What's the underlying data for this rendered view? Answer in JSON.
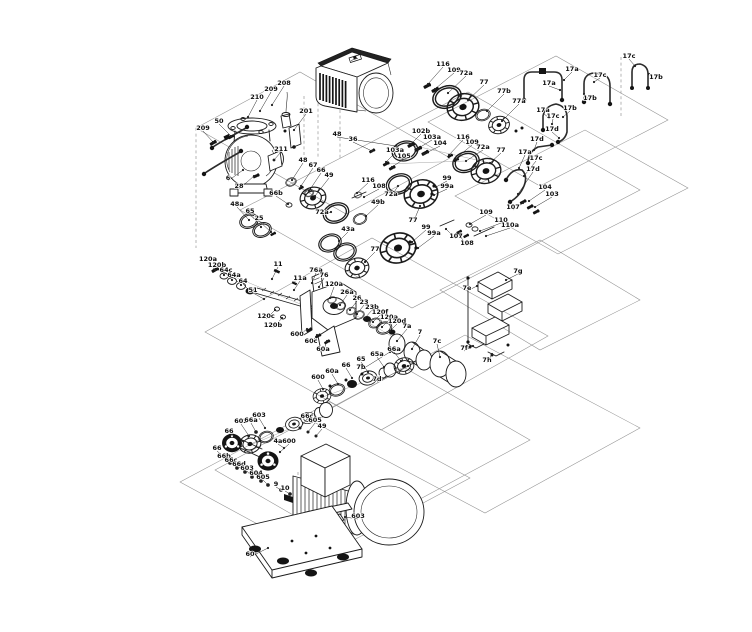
{
  "diagram": {
    "description": "Exploded parts diagram of a centrifugal pump unit with drive head, shaft seal kits, vent pipe kits, bearing assembly, impeller stack, coupling, motor and base plate",
    "colors": {
      "background": "#ffffff",
      "line": "#1c1c1c",
      "label": "#0e0e0e"
    },
    "callouts": [
      {
        "t": "209",
        "x": 203,
        "y": 130,
        "ex": 213,
        "ey": 142
      },
      {
        "t": "50",
        "x": 219,
        "y": 123,
        "ex": 231,
        "ey": 136
      },
      {
        "t": "210",
        "x": 257,
        "y": 99,
        "ex": 248,
        "ey": 117
      },
      {
        "t": "209",
        "x": 271,
        "y": 91,
        "ex": 260,
        "ey": 111
      },
      {
        "t": "208",
        "x": 284,
        "y": 85,
        "ex": 272,
        "ey": 105
      },
      {
        "t": "201",
        "x": 306,
        "y": 113,
        "ex": 294,
        "ey": 130
      },
      {
        "t": "211",
        "x": 281,
        "y": 151,
        "ex": 274,
        "ey": 160
      },
      {
        "t": "6",
        "x": 228,
        "y": 180,
        "ex": 243,
        "ey": 170
      },
      {
        "t": "28",
        "x": 239,
        "y": 188,
        "ex": 254,
        "ey": 176
      },
      {
        "t": "48",
        "x": 337,
        "y": 136,
        "ex": 396,
        "ey": 146
      },
      {
        "t": "36",
        "x": 353,
        "y": 141,
        "ex": 372,
        "ey": 151
      },
      {
        "t": "116",
        "x": 443,
        "y": 66,
        "ex": 428,
        "ey": 84
      },
      {
        "t": "109",
        "x": 454,
        "y": 72,
        "ex": 435,
        "ey": 89
      },
      {
        "t": "72a",
        "x": 466,
        "y": 75,
        "ex": 448,
        "ey": 93
      },
      {
        "t": "77",
        "x": 484,
        "y": 84,
        "ex": 468,
        "ey": 100
      },
      {
        "t": "77b",
        "x": 504,
        "y": 93,
        "ex": 487,
        "ey": 111
      },
      {
        "t": "77a",
        "x": 519,
        "y": 103,
        "ex": 502,
        "ey": 121
      },
      {
        "t": "102b",
        "x": 421,
        "y": 133,
        "ex": 411,
        "ey": 144
      },
      {
        "t": "103a",
        "x": 432,
        "y": 139,
        "ex": 417,
        "ey": 149
      },
      {
        "t": "104",
        "x": 440,
        "y": 145,
        "ex": 424,
        "ey": 154
      },
      {
        "t": "116",
        "x": 463,
        "y": 139,
        "ex": 449,
        "ey": 155
      },
      {
        "t": "109",
        "x": 472,
        "y": 144,
        "ex": 455,
        "ey": 159
      },
      {
        "t": "72a",
        "x": 483,
        "y": 149,
        "ex": 466,
        "ey": 161
      },
      {
        "t": "77",
        "x": 501,
        "y": 152,
        "ex": 490,
        "ey": 163
      },
      {
        "t": "103a",
        "x": 395,
        "y": 152,
        "ex": 386,
        "ey": 162
      },
      {
        "t": "105",
        "x": 404,
        "y": 158,
        "ex": 392,
        "ey": 167
      },
      {
        "t": "116",
        "x": 368,
        "y": 182,
        "ex": 357,
        "ey": 193
      },
      {
        "t": "108",
        "x": 379,
        "y": 188,
        "ex": 364,
        "ey": 197
      },
      {
        "t": "72a",
        "x": 391,
        "y": 196,
        "ex": 398,
        "ey": 186
      },
      {
        "t": "99",
        "x": 447,
        "y": 180,
        "ex": 436,
        "ey": 187
      },
      {
        "t": "99a",
        "x": 447,
        "y": 188,
        "ex": 434,
        "ey": 195
      },
      {
        "t": "77",
        "x": 413,
        "y": 222,
        "ex": 420,
        "ey": 206
      },
      {
        "t": "99",
        "x": 426,
        "y": 229,
        "ex": 412,
        "ey": 242
      },
      {
        "t": "99a",
        "x": 434,
        "y": 235,
        "ex": 418,
        "ey": 248
      },
      {
        "t": "77",
        "x": 375,
        "y": 251,
        "ex": 365,
        "ey": 262
      },
      {
        "t": "72a",
        "x": 322,
        "y": 214,
        "ex": 331,
        "ey": 212
      },
      {
        "t": "49b",
        "x": 378,
        "y": 204,
        "ex": 366,
        "ey": 216
      },
      {
        "t": "43a",
        "x": 348,
        "y": 231,
        "ex": 339,
        "ey": 241
      },
      {
        "t": "48a",
        "x": 237,
        "y": 206,
        "ex": 249,
        "ey": 220
      },
      {
        "t": "65",
        "x": 250,
        "y": 213,
        "ex": 261,
        "ey": 227
      },
      {
        "t": "25",
        "x": 259,
        "y": 220,
        "ex": 271,
        "ey": 232
      },
      {
        "t": "66b",
        "x": 276,
        "y": 195,
        "ex": 288,
        "ey": 204
      },
      {
        "t": "48",
        "x": 303,
        "y": 162,
        "ex": 292,
        "ey": 180
      },
      {
        "t": "67",
        "x": 313,
        "y": 167,
        "ex": 301,
        "ey": 186
      },
      {
        "t": "66",
        "x": 321,
        "y": 172,
        "ex": 309,
        "ey": 191
      },
      {
        "t": "49",
        "x": 329,
        "y": 177,
        "ex": 315,
        "ey": 196
      },
      {
        "t": "120a",
        "x": 208,
        "y": 261,
        "ex": 215,
        "ey": 270
      },
      {
        "t": "120b",
        "x": 217,
        "y": 267,
        "ex": 224,
        "ey": 275
      },
      {
        "t": "64c",
        "x": 226,
        "y": 272,
        "ex": 232,
        "ey": 280
      },
      {
        "t": "64a",
        "x": 234,
        "y": 277,
        "ex": 241,
        "ey": 285
      },
      {
        "t": "64",
        "x": 243,
        "y": 283,
        "ex": 250,
        "ey": 291
      },
      {
        "t": "51",
        "x": 253,
        "y": 292,
        "ex": 264,
        "ey": 299
      },
      {
        "t": "11",
        "x": 278,
        "y": 266,
        "ex": 272,
        "ey": 279
      },
      {
        "t": "11a",
        "x": 300,
        "y": 280,
        "ex": 294,
        "ey": 290
      },
      {
        "t": "76a",
        "x": 316,
        "y": 272,
        "ex": 312,
        "ey": 283
      },
      {
        "t": "76",
        "x": 324,
        "y": 277,
        "ex": 319,
        "ey": 287
      },
      {
        "t": "120c",
        "x": 266,
        "y": 318,
        "ex": 275,
        "ey": 310
      },
      {
        "t": "120b",
        "x": 273,
        "y": 327,
        "ex": 282,
        "ey": 318
      },
      {
        "t": "120a",
        "x": 334,
        "y": 286,
        "ex": 330,
        "ey": 298
      },
      {
        "t": "26a",
        "x": 347,
        "y": 294,
        "ex": 340,
        "ey": 305
      },
      {
        "t": "26",
        "x": 357,
        "y": 300,
        "ex": 350,
        "ey": 310
      },
      {
        "t": "23",
        "x": 364,
        "y": 304,
        "ex": 357,
        "ey": 314
      },
      {
        "t": "23b",
        "x": 372,
        "y": 309,
        "ex": 365,
        "ey": 318
      },
      {
        "t": "120f",
        "x": 380,
        "y": 314,
        "ex": 373,
        "ey": 322
      },
      {
        "t": "120a",
        "x": 389,
        "y": 319,
        "ex": 382,
        "ey": 327
      },
      {
        "t": "120d",
        "x": 397,
        "y": 323,
        "ex": 390,
        "ey": 331
      },
      {
        "t": "7a",
        "x": 407,
        "y": 328,
        "ex": 397,
        "ey": 341
      },
      {
        "t": "7",
        "x": 420,
        "y": 334,
        "ex": 412,
        "ey": 349
      },
      {
        "t": "7c",
        "x": 437,
        "y": 343,
        "ex": 440,
        "ey": 357
      },
      {
        "t": "7b",
        "x": 361,
        "y": 369,
        "ex": 390,
        "ey": 352
      },
      {
        "t": "7d",
        "x": 377,
        "y": 381,
        "ex": 408,
        "ey": 366
      },
      {
        "t": "600",
        "x": 297,
        "y": 336,
        "ex": 307,
        "ey": 329
      },
      {
        "t": "60c",
        "x": 311,
        "y": 343,
        "ex": 317,
        "ey": 335
      },
      {
        "t": "60a",
        "x": 323,
        "y": 351,
        "ex": 327,
        "ey": 341
      },
      {
        "t": "7g",
        "x": 518,
        "y": 273,
        "ex": 506,
        "ey": 280
      },
      {
        "t": "7e",
        "x": 467,
        "y": 290,
        "ex": 477,
        "ey": 286
      },
      {
        "t": "7f",
        "x": 464,
        "y": 350,
        "ex": 473,
        "ey": 346
      },
      {
        "t": "7h",
        "x": 487,
        "y": 362,
        "ex": 492,
        "ey": 354
      },
      {
        "t": "107",
        "x": 456,
        "y": 238,
        "ex": 446,
        "ey": 229
      },
      {
        "t": "108",
        "x": 467,
        "y": 245,
        "ex": 458,
        "ey": 233
      },
      {
        "t": "109",
        "x": 486,
        "y": 214,
        "ex": 470,
        "ey": 224
      },
      {
        "t": "110",
        "x": 501,
        "y": 222,
        "ex": 480,
        "ey": 231
      },
      {
        "t": "110a",
        "x": 510,
        "y": 227,
        "ex": 486,
        "ey": 236
      },
      {
        "t": "107",
        "x": 513,
        "y": 209,
        "ex": 523,
        "ey": 203
      },
      {
        "t": "104",
        "x": 545,
        "y": 189,
        "ex": 529,
        "ey": 201
      },
      {
        "t": "103",
        "x": 552,
        "y": 196,
        "ex": 535,
        "ey": 207
      },
      {
        "t": "17a",
        "x": 572,
        "y": 71,
        "ex": 564,
        "ey": 80
      },
      {
        "t": "17c",
        "x": 600,
        "y": 77,
        "ex": 594,
        "ey": 82
      },
      {
        "t": "17a",
        "x": 549,
        "y": 85,
        "ex": 560,
        "ey": 90
      },
      {
        "t": "17b",
        "x": 590,
        "y": 100,
        "ex": 584,
        "ey": 94
      },
      {
        "t": "17b",
        "x": 570,
        "y": 110,
        "ex": 563,
        "ey": 117
      },
      {
        "t": "17a",
        "x": 543,
        "y": 112,
        "ex": 549,
        "ey": 118
      },
      {
        "t": "17c",
        "x": 553,
        "y": 118,
        "ex": 552,
        "ey": 124
      },
      {
        "t": "17d",
        "x": 552,
        "y": 131,
        "ex": 559,
        "ey": 138
      },
      {
        "t": "17d",
        "x": 537,
        "y": 141,
        "ex": 534,
        "ey": 150
      },
      {
        "t": "17a",
        "x": 525,
        "y": 154,
        "ex": 519,
        "ey": 168
      },
      {
        "t": "17c",
        "x": 536,
        "y": 160,
        "ex": 524,
        "ey": 176
      },
      {
        "t": "17d",
        "x": 533,
        "y": 171,
        "ex": 518,
        "ey": 194
      },
      {
        "t": "17c",
        "x": 629,
        "y": 58,
        "ex": 635,
        "ey": 66
      },
      {
        "t": "17b",
        "x": 656,
        "y": 79,
        "ex": 649,
        "ey": 74
      },
      {
        "t": "600",
        "x": 318,
        "y": 379,
        "ex": 323,
        "ey": 389
      },
      {
        "t": "60a",
        "x": 332,
        "y": 373,
        "ex": 338,
        "ey": 384
      },
      {
        "t": "66",
        "x": 346,
        "y": 367,
        "ex": 352,
        "ey": 378
      },
      {
        "t": "65",
        "x": 361,
        "y": 361,
        "ex": 368,
        "ey": 372
      },
      {
        "t": "65a",
        "x": 377,
        "y": 356,
        "ex": 384,
        "ey": 367
      },
      {
        "t": "66a",
        "x": 394,
        "y": 351,
        "ex": 401,
        "ey": 361
      },
      {
        "t": "602",
        "x": 241,
        "y": 423,
        "ex": 249,
        "ey": 436
      },
      {
        "t": "66",
        "x": 229,
        "y": 433,
        "ex": 243,
        "ey": 441
      },
      {
        "t": "603",
        "x": 259,
        "y": 417,
        "ex": 265,
        "ey": 428
      },
      {
        "t": "66c",
        "x": 307,
        "y": 418,
        "ex": 300,
        "ey": 428
      },
      {
        "t": "605",
        "x": 315,
        "y": 422,
        "ex": 308,
        "ey": 432
      },
      {
        "t": "49",
        "x": 322,
        "y": 428,
        "ex": 316,
        "ey": 436
      },
      {
        "t": "4a",
        "x": 278,
        "y": 443,
        "ex": 284,
        "ey": 448
      },
      {
        "t": "66a",
        "x": 251,
        "y": 422,
        "ex": 256,
        "ey": 432
      },
      {
        "t": "600",
        "x": 289,
        "y": 443,
        "ex": 280,
        "ey": 452
      },
      {
        "t": "66",
        "x": 217,
        "y": 450,
        "ex": 224,
        "ey": 457
      },
      {
        "t": "66b",
        "x": 224,
        "y": 458,
        "ex": 230,
        "ey": 463
      },
      {
        "t": "66c",
        "x": 231,
        "y": 462,
        "ex": 237,
        "ey": 468
      },
      {
        "t": "66d",
        "x": 239,
        "y": 466,
        "ex": 245,
        "ey": 472
      },
      {
        "t": "603",
        "x": 247,
        "y": 470,
        "ex": 252,
        "ey": 477
      },
      {
        "t": "604",
        "x": 256,
        "y": 475,
        "ex": 261,
        "ey": 481
      },
      {
        "t": "605",
        "x": 263,
        "y": 479,
        "ex": 268,
        "ey": 485
      },
      {
        "t": "9",
        "x": 276,
        "y": 486,
        "ex": 281,
        "ey": 490
      },
      {
        "t": "10",
        "x": 285,
        "y": 490,
        "ex": 290,
        "ey": 494
      },
      {
        "t": "603",
        "x": 358,
        "y": 518,
        "ex": 345,
        "ey": 517
      },
      {
        "t": "60",
        "x": 250,
        "y": 556,
        "ex": 268,
        "ey": 548
      }
    ]
  }
}
